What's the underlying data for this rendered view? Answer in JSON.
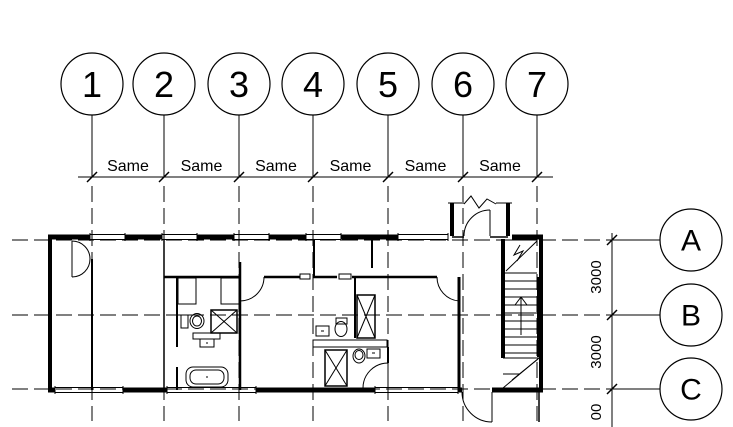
{
  "drawing": {
    "name": "Floor plan with grid bubbles and dimensions",
    "grid_columns": [
      {
        "label": "1"
      },
      {
        "label": "2"
      },
      {
        "label": "3"
      },
      {
        "label": "4"
      },
      {
        "label": "5"
      },
      {
        "label": "6"
      },
      {
        "label": "7"
      }
    ],
    "grid_rows": [
      {
        "label": "A"
      },
      {
        "label": "B"
      },
      {
        "label": "C"
      }
    ],
    "dim_top": {
      "labels": [
        "Same",
        "Same",
        "Same",
        "Same",
        "Same",
        "Same"
      ]
    },
    "dim_right": {
      "labels": [
        "3000",
        "3000",
        "00"
      ]
    },
    "colors": {
      "line": "#000000",
      "background": "#ffffff"
    }
  }
}
